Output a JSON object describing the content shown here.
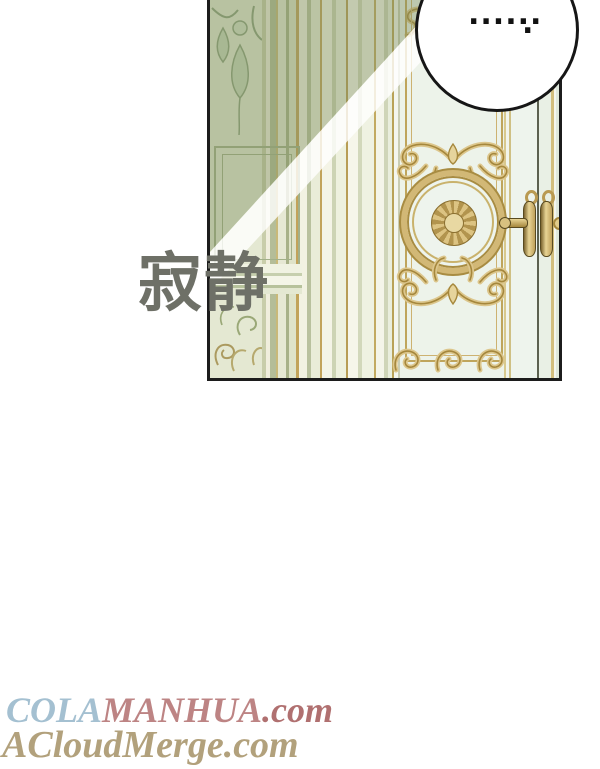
{
  "panel": {
    "wall_color": "#edf2e6",
    "door_color": "#eef4ed",
    "gold_color": "#c9ab62",
    "shadow_color": "rgba(125,140,92,0.42)",
    "border_color": "#1c1c1c"
  },
  "speech_bubble": {
    "dots": "......",
    "trailing_dot": ".",
    "fill": "#ffffff",
    "stroke_color": "#161616"
  },
  "sfx": {
    "text": "寂静",
    "color": "#6e7067"
  },
  "watermarks": {
    "line1": {
      "parts": [
        {
          "text": "COLA",
          "color": "#a4c0d1"
        },
        {
          "text": "MANHUA",
          "color": "#bd8484"
        },
        {
          "text": ".com",
          "color": "#b07070"
        }
      ]
    },
    "line2": {
      "text": "ACloudMerge.com",
      "color": "#b2a17c"
    }
  }
}
